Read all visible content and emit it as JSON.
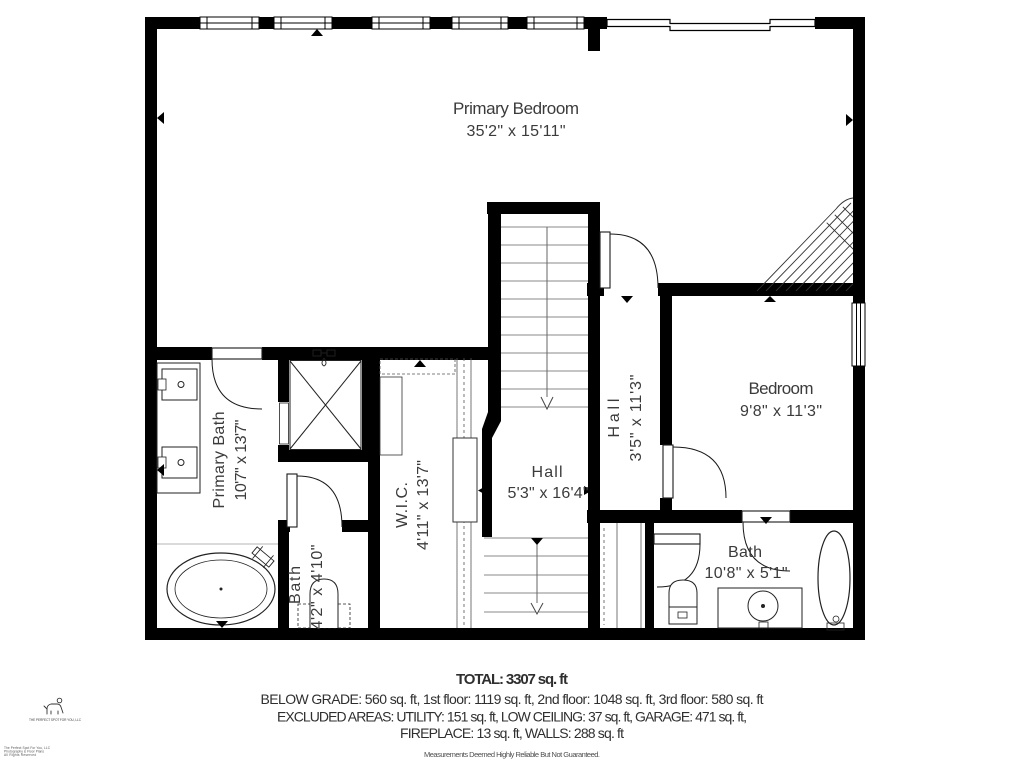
{
  "rooms": {
    "primary_bedroom": {
      "name": "Primary Bedroom",
      "dims": "35'2\" x 15'11\""
    },
    "bedroom": {
      "name": "Bedroom",
      "dims": "9'8\" x 11'3\""
    },
    "hall_main": {
      "name": "Hall",
      "dims": "5'3\" x 16'4\""
    },
    "hall_upper": {
      "name": "Hall",
      "dims": "3'5\" x 11'3\""
    },
    "primary_bath": {
      "name": "Primary Bath",
      "dims": "10'7\" x 13'7\""
    },
    "wic": {
      "name": "W.I.C.",
      "dims": "4'11\" x 13'7\""
    },
    "bath_small": {
      "name": "Bath",
      "dims": "4'2\" x 4'10\""
    },
    "bath": {
      "name": "Bath",
      "dims": "10'8\" x 5'1\""
    }
  },
  "summary": {
    "total": "TOTAL: 3307 sq. ft",
    "line1": "BELOW GRADE: 560 sq. ft, 1st floor: 1119 sq. ft, 2nd floor: 1048 sq. ft, 3rd floor: 580 sq. ft",
    "line2": "EXCLUDED AREAS: UTILITY: 151 sq. ft, LOW CEILING: 37 sq. ft, GARAGE: 471 sq. ft,",
    "line3": "FIREPLACE: 13 sq. ft, WALLS: 288 sq. ft",
    "disclaimer": "Measurements Deemed Highly Reliable But Not Guaranteed."
  },
  "branding": {
    "logo_caption": "THE PERFECT SPOT FOR YOU, LLC",
    "fine_print": [
      "The Perfect Spot For You, LLC",
      "Photography & Floor Plans",
      "All Rights Reserved"
    ]
  },
  "colors": {
    "wall": "#000000",
    "label_text": "#3b3b3b",
    "summary_text": "#2f2f2f",
    "disclaimer_text": "#4f4f4f",
    "tread_line": "#8a8a8a",
    "fixture_line": "#222222"
  }
}
